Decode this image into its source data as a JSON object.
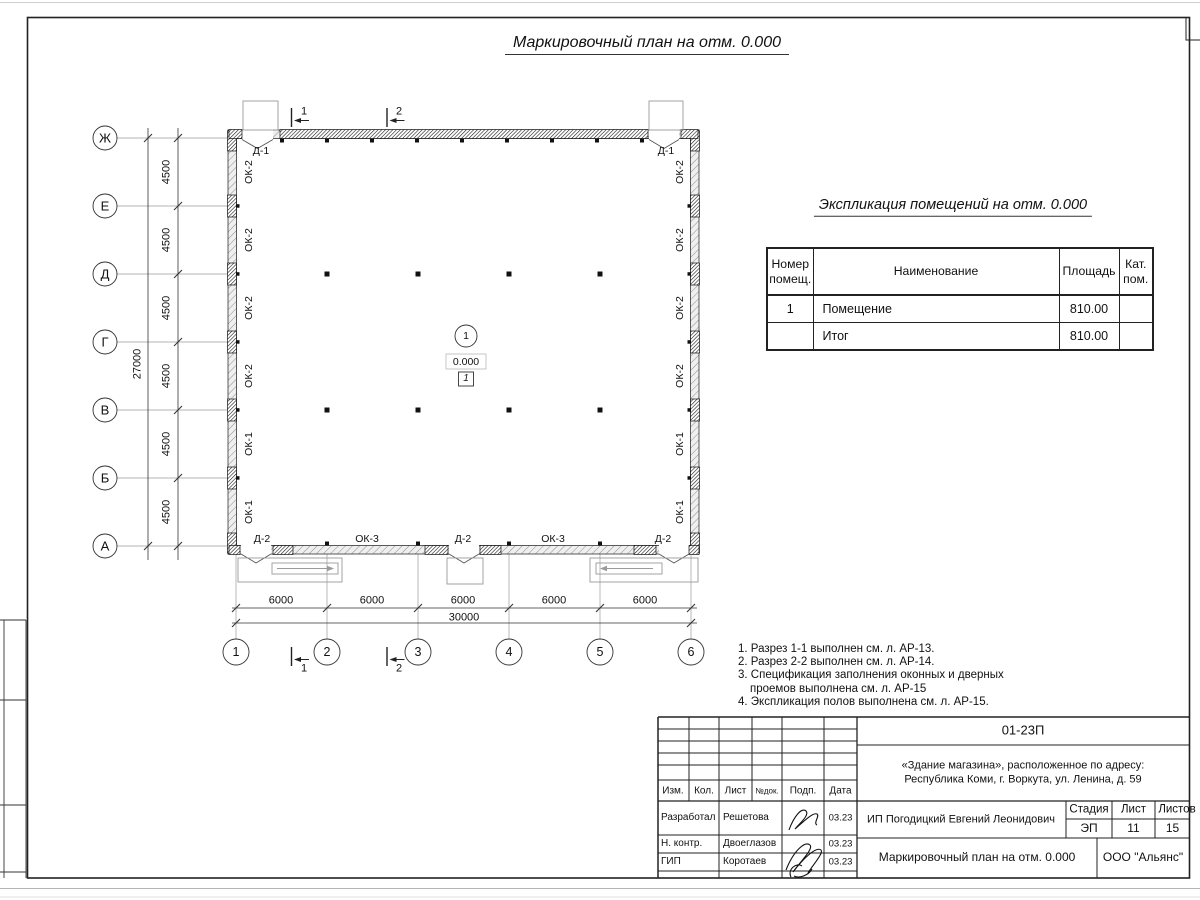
{
  "sheet": {
    "title": "Маркировочный план на отм. 0.000"
  },
  "plan": {
    "row_axes": [
      "Ж",
      "Е",
      "Д",
      "Г",
      "В",
      "Б",
      "А"
    ],
    "col_axes": [
      "1",
      "2",
      "3",
      "4",
      "5",
      "6"
    ],
    "row_dims": [
      "4500",
      "4500",
      "4500",
      "4500",
      "4500",
      "4500"
    ],
    "row_total": "27000",
    "col_dims": [
      "6000",
      "6000",
      "6000",
      "6000",
      "6000"
    ],
    "col_total": "30000",
    "left_windows": [
      "ОК-2",
      "ОК-2",
      "ОК-2",
      "ОК-2",
      "ОК-1",
      "ОК-1"
    ],
    "right_windows": [
      "ОК-2",
      "ОК-2",
      "ОК-2",
      "ОК-2",
      "ОК-1",
      "ОК-1"
    ],
    "top_doors": [
      "Д-1",
      "Д-1"
    ],
    "bottom_items": [
      "Д-2",
      "ОК-3",
      "Д-2",
      "ОК-3",
      "Д-2"
    ],
    "sections": {
      "top": [
        "1",
        "2"
      ],
      "bottom": [
        "1",
        "2"
      ]
    },
    "room": {
      "number": "1",
      "elevation": "0.000",
      "floor_type": "1"
    }
  },
  "explication": {
    "title": "Экспликация помещений на отм. 0.000",
    "col_number": "Номер помещ.",
    "col_name": "Наименование",
    "col_area": "Площадь",
    "col_cat": "Кат. пом.",
    "rows": [
      {
        "num": "1",
        "name": "Помещение",
        "area": "810.00",
        "cat": ""
      },
      {
        "num": "",
        "name": "Итог",
        "area": "810.00",
        "cat": ""
      }
    ]
  },
  "notes": [
    "1. Разрез 1-1 выполнен см. л. АР-13.",
    "2. Разрез 2-2 выполнен см. л. АР-14.",
    "3. Спецификация заполнения оконных и дверных\nпроемов выполнена см. л. АР-15",
    "4. Экспликация полов выполнена см. л. АР-15."
  ],
  "title_block": {
    "code": "01-23П",
    "object_line1": "«Здание магазина», расположенное по адресу:",
    "object_line2": "Республика Коми, г. Воркута, ул. Ленина, д. 59",
    "client": "ИП Погодицкий Евгений Леонидович",
    "doc_title": "Маркировочный план на отм. 0.000",
    "company": "ООО \"Альянс\"",
    "stage_label": "Стадия",
    "sheet_label": "Лист",
    "sheets_label": "Листов",
    "stage": "ЭП",
    "sheet_num": "11",
    "sheets_total": "15",
    "cols": [
      "Изм.",
      "Кол.",
      "Лист",
      "№док.",
      "Подп.",
      "Дата"
    ],
    "rows": [
      {
        "role": "Разработал",
        "name": "Решетова",
        "date": "03.23"
      },
      {
        "role": "Н. контр.",
        "name": "Двоеглазов",
        "date": "03.23"
      },
      {
        "role": "ГИП",
        "name": "Коротаев",
        "date": "03.23"
      }
    ]
  }
}
